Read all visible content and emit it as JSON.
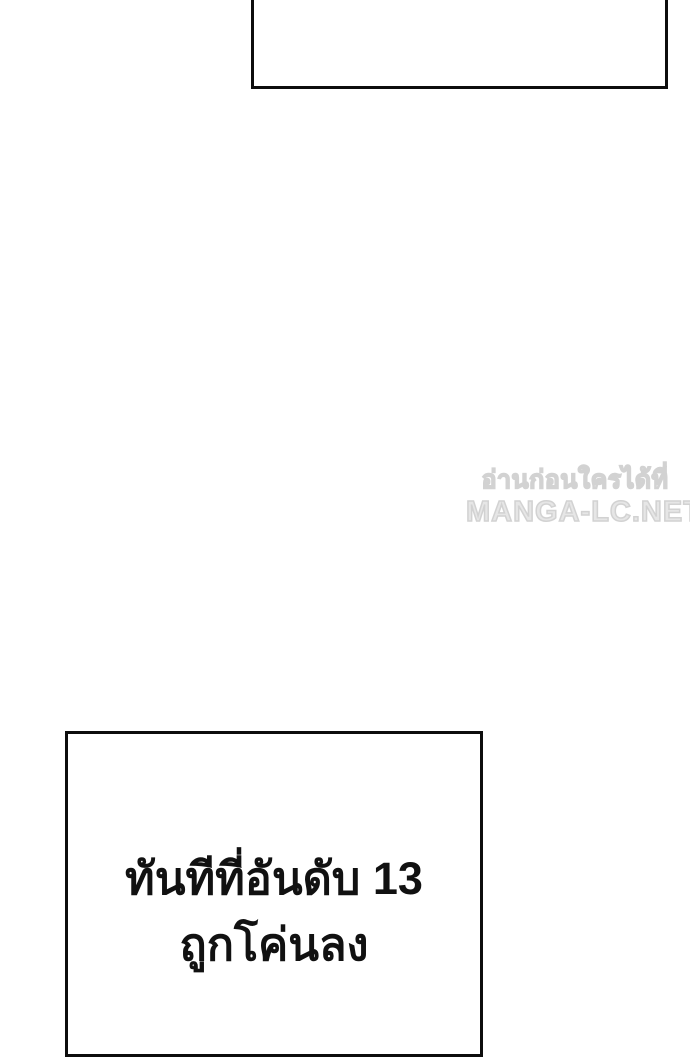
{
  "page": {
    "background_color": "#ffffff",
    "panel_border_color": "#0d0d0d",
    "caption_text_color": "#111111"
  },
  "top_panel": {
    "content": ""
  },
  "watermark": {
    "line1": "อ่านก่อนใครได้ที่",
    "line2": "MANGA-LC.NET",
    "color": "#d2d2d2"
  },
  "bottom_panel": {
    "caption_line1": "ทันทีที่อันดับ 13",
    "caption_line2": "ถูกโค่นลง"
  }
}
